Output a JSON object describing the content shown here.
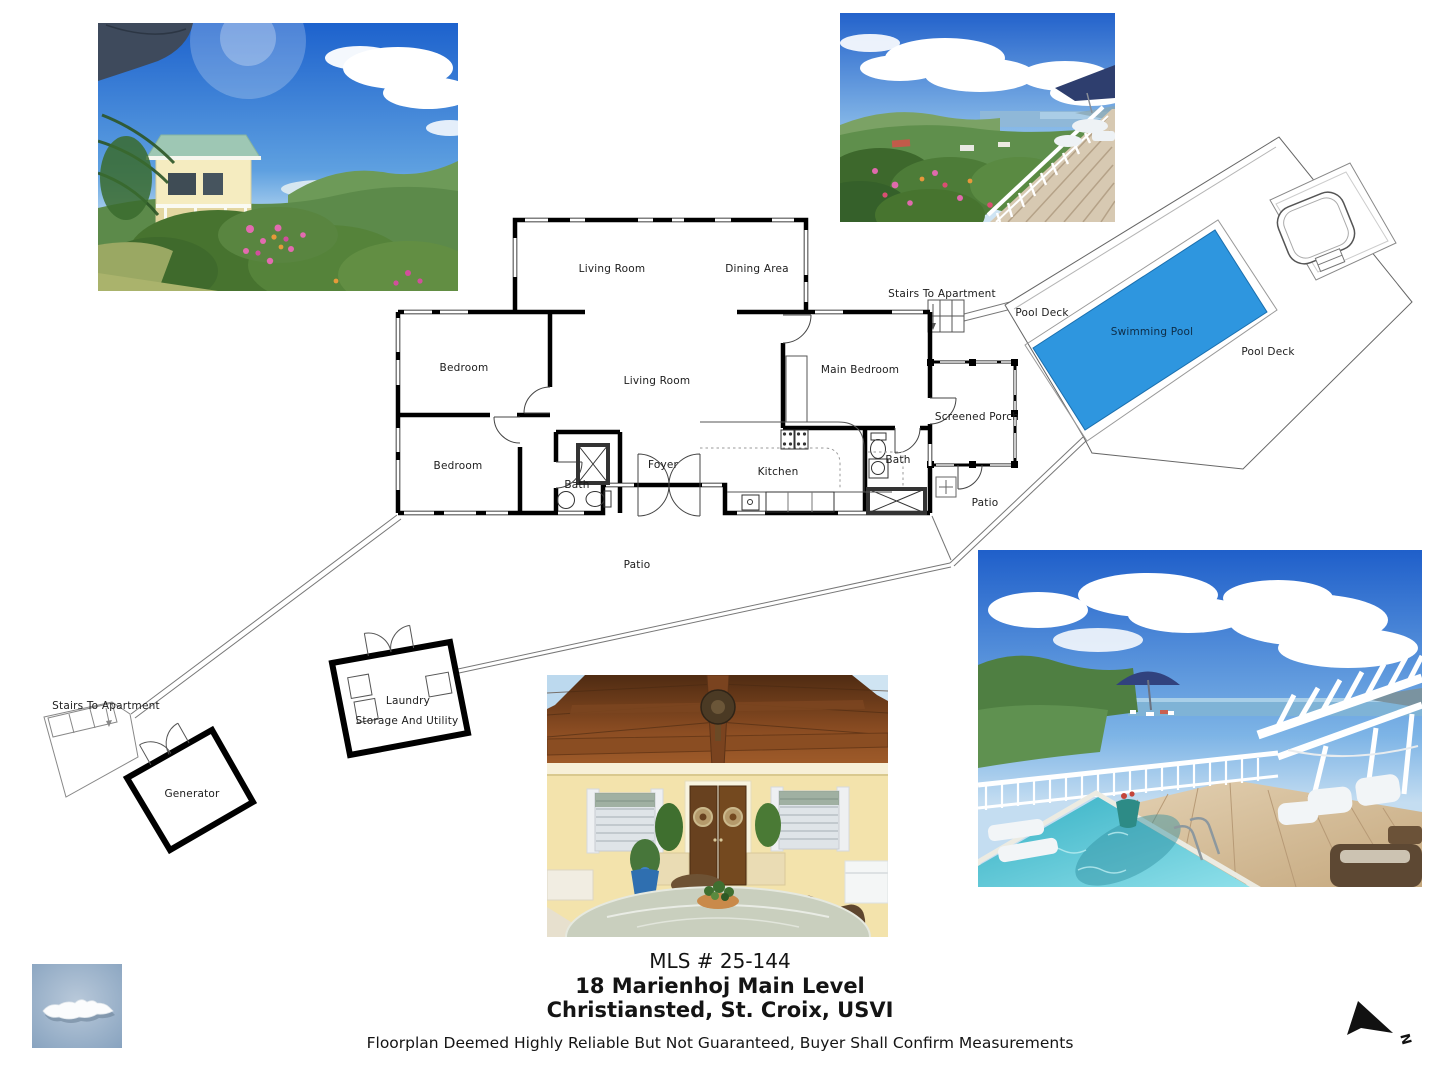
{
  "listing": {
    "mls": "MLS # 25-144",
    "address_line1": "18 Marienhoj Main Level",
    "address_line2": "Christiansted, St. Croix, USVI",
    "disclaimer": "Floorplan Deemed Highly Reliable But Not Guaranteed, Buyer Shall Confirm Measurements"
  },
  "floorplan": {
    "pool_color": "#2E96DF",
    "labels": {
      "living_room_top": "Living Room",
      "dining_area": "Dining Area",
      "bedroom_upper": "Bedroom",
      "bedroom_lower": "Bedroom",
      "living_room_main": "Living Room",
      "main_bedroom": "Main Bedroom",
      "foyer": "Foyer",
      "kitchen": "Kitchen",
      "bath_left": "Bath",
      "bath_right": "Bath",
      "screened_porch": "Screened Porch",
      "patio_right": "Patio",
      "patio_main": "Patio",
      "stairs_top": "Stairs To Apartment",
      "stairs_bottom": "Stairs To Apartment",
      "laundry": "Laundry",
      "storage": "Storage And Utility",
      "generator": "Generator",
      "pool_deck_left": "Pool Deck",
      "pool_deck_right": "Pool Deck",
      "swimming_pool": "Swimming Pool"
    },
    "compass": {
      "north": "N"
    }
  }
}
